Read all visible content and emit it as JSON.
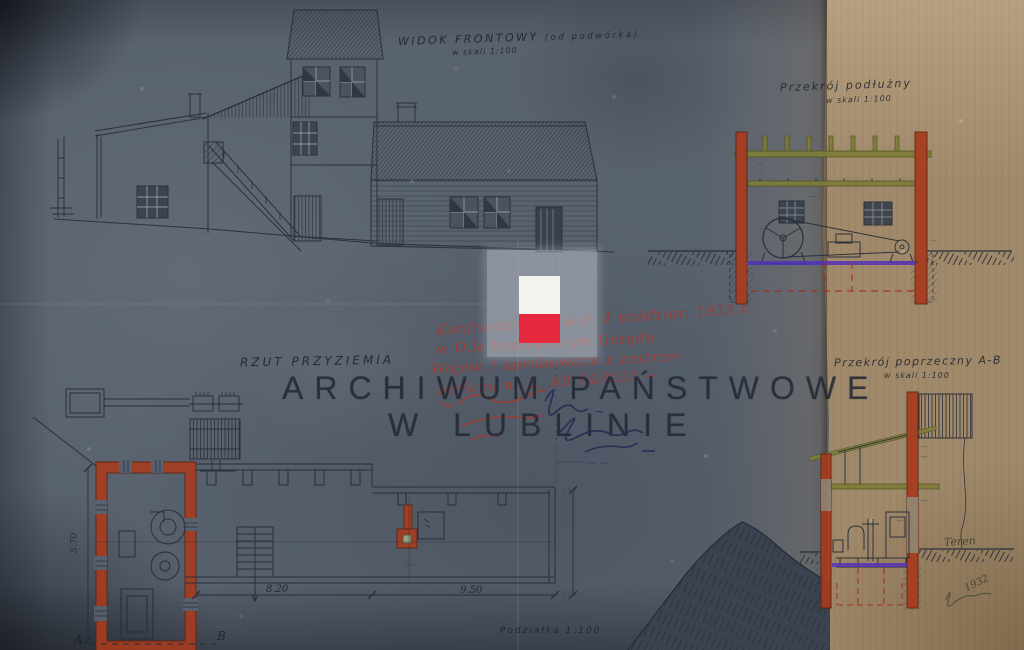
{
  "archive": {
    "watermark_line1": "ARCHIWUM PAŃSTWOWE",
    "watermark_line2": "W LUBLINIE"
  },
  "titles": {
    "front_view": "WIDOK FRONTOWY",
    "front_view_sub": "(od podwórka)",
    "front_view_scale": "w skali 1:100",
    "long_section": "Przekrój podłużny",
    "long_section_scale": "w skali 1:100",
    "cross_section": "Przekrój poprzeczny A-B",
    "cross_section_scale": "w skali 1:100",
    "plan": "RZUT PRZYZIEMIA",
    "scale_bar": "Podziałka 1:100"
  },
  "dimensions": {
    "hall_width": "8.20",
    "mill_room_width": "9.50",
    "room_depth": "5.70"
  },
  "markers": {
    "section_a": "A",
    "section_b": "B",
    "terrain": "Teren",
    "signature_year": "1932"
  },
  "approval_note": {
    "line1": "Konfrontowano w d. 4 paździer. 1933 r.",
    "line2": "w O.le budowlanym Urzędu",
    "line3": "Wojew. i aprobowano z zastrze-",
    "line4": "żeniami na L. AB-14/9/33 —"
  },
  "colors": {
    "paper_blue": "#59626f",
    "paper_tan": "#a18a6b",
    "drawing_ink": "#242b36",
    "wall_red": "#a83b1e",
    "timber_olive": "#7e7d3a",
    "floor_purple": "#4f2bc0",
    "note_red": "#a8382b",
    "flag_white": "#f3f2ee",
    "flag_red": "#e5283e"
  }
}
